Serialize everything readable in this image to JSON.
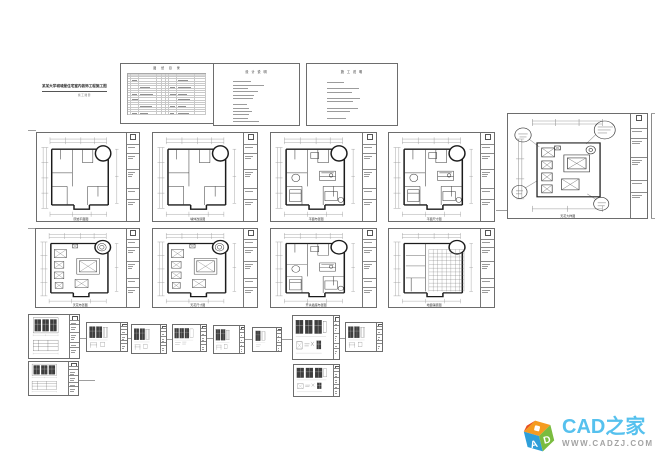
{
  "canvas": {
    "width": 655,
    "height": 460,
    "background": "#ffffff"
  },
  "cover": {
    "title": "某某大学城城堡住宅室内装饰工程施工图",
    "subtitle": "施 工 图 册"
  },
  "index_sheet": {
    "title": "图 纸 目 录",
    "rows": 17,
    "cols": 9
  },
  "notes_sheets": [
    {
      "title": "设 计 说 明",
      "lines": [
        0,
        34,
        58,
        28,
        46,
        40,
        38,
        0,
        26,
        30,
        36,
        30,
        28,
        48
      ]
    },
    {
      "title": "施 工 说 明",
      "lines": [
        0,
        30,
        0,
        56,
        44,
        0,
        58,
        46,
        0,
        54,
        40,
        0,
        34
      ]
    }
  ],
  "sheets": [
    {
      "name": "sheet-cover",
      "type": "cover",
      "label": "",
      "x": 42,
      "y": 84,
      "w": 66,
      "h": 16
    },
    {
      "name": "sheet-index",
      "type": "index",
      "label": "",
      "x": 120,
      "y": 63,
      "w": 95,
      "h": 61
    },
    {
      "name": "sheet-notes-1",
      "type": "notes",
      "idx": 0,
      "label": "",
      "x": 213,
      "y": 63,
      "w": 87,
      "h": 63
    },
    {
      "name": "sheet-notes-2",
      "type": "notes",
      "idx": 1,
      "label": "",
      "x": 306,
      "y": 63,
      "w": 92,
      "h": 63
    },
    {
      "name": "sheet-original-plan",
      "type": "plan",
      "variant": "walls",
      "label": "原始平面图",
      "x": 36,
      "y": 132,
      "w": 104,
      "h": 90
    },
    {
      "name": "sheet-wall-modify-plan",
      "type": "plan",
      "variant": "walls",
      "label": "墙体改造图",
      "x": 152,
      "y": 132,
      "w": 106,
      "h": 90
    },
    {
      "name": "sheet-furniture-plan",
      "type": "plan",
      "variant": "furniture",
      "label": "平面布置图",
      "x": 270,
      "y": 132,
      "w": 107,
      "h": 90
    },
    {
      "name": "sheet-furniture-dim-plan",
      "type": "plan",
      "variant": "furniture",
      "label": "平面尺寸图",
      "x": 388,
      "y": 132,
      "w": 107,
      "h": 90
    },
    {
      "name": "sheet-ceiling-plan",
      "type": "plan",
      "variant": "ceiling",
      "label": "天花布置图",
      "x": 35,
      "y": 228,
      "w": 105,
      "h": 80
    },
    {
      "name": "sheet-ceiling-dim-plan",
      "type": "plan",
      "variant": "ceiling",
      "label": "天花尺寸图",
      "x": 152,
      "y": 228,
      "w": 106,
      "h": 80
    },
    {
      "name": "sheet-switch-plan",
      "type": "plan",
      "variant": "furniture",
      "label": "开关插座布置图",
      "x": 270,
      "y": 228,
      "w": 107,
      "h": 80
    },
    {
      "name": "sheet-floor-paving-plan",
      "type": "plan",
      "variant": "floor",
      "label": "地面铺装图",
      "x": 388,
      "y": 228,
      "w": 107,
      "h": 80
    },
    {
      "name": "sheet-ceiling-detail",
      "type": "plan",
      "variant": "ceilinglarge",
      "label": "天花大样图",
      "x": 507,
      "y": 113,
      "w": 141,
      "h": 106
    },
    {
      "name": "sheet-elevation-1",
      "type": "elev",
      "variant": "stacked",
      "label": "立面图",
      "x": 28,
      "y": 314,
      "w": 52,
      "h": 45
    },
    {
      "name": "sheet-elevation-2",
      "type": "elev",
      "variant": "p2",
      "label": "立面图",
      "x": 86,
      "y": 322,
      "w": 42,
      "h": 30
    },
    {
      "name": "sheet-elevation-3",
      "type": "elev",
      "variant": "p2",
      "label": "立面图",
      "x": 131,
      "y": 324,
      "w": 36,
      "h": 30
    },
    {
      "name": "sheet-elevation-4",
      "type": "elev",
      "variant": "p3",
      "label": "立面图",
      "x": 172,
      "y": 324,
      "w": 35,
      "h": 28
    },
    {
      "name": "sheet-elevation-5",
      "type": "elev",
      "variant": "p2",
      "label": "立面图",
      "x": 213,
      "y": 325,
      "w": 32,
      "h": 29
    },
    {
      "name": "sheet-elevation-6",
      "type": "elev",
      "variant": "p1",
      "label": "立面图",
      "x": 252,
      "y": 327,
      "w": 30,
      "h": 25
    },
    {
      "name": "sheet-elevation-7",
      "type": "elev",
      "variant": "big",
      "label": "立面图",
      "x": 292,
      "y": 315,
      "w": 48,
      "h": 45
    },
    {
      "name": "sheet-elevation-8",
      "type": "elev",
      "variant": "p2",
      "label": "立面图",
      "x": 345,
      "y": 322,
      "w": 38,
      "h": 30
    },
    {
      "name": "sheet-elevation-9",
      "type": "elev",
      "variant": "stacked",
      "label": "立面图",
      "x": 28,
      "y": 361,
      "w": 51,
      "h": 35
    },
    {
      "name": "sheet-elevation-10",
      "type": "elev",
      "variant": "big",
      "label": "立面图",
      "x": 293,
      "y": 364,
      "w": 47,
      "h": 33
    }
  ],
  "logo": {
    "title": "CAD之家",
    "url": "WWW.CADZJ.COM",
    "cube_letters": {
      "left": "A",
      "right": "D"
    },
    "colors": {
      "title": "#56c1ee",
      "url": "#a3a3a3",
      "cube_top": "#f59b20",
      "cube_left": "#2e9fd9",
      "cube_right": "#7abc3f",
      "cube_accent": "#e84e1b"
    }
  }
}
